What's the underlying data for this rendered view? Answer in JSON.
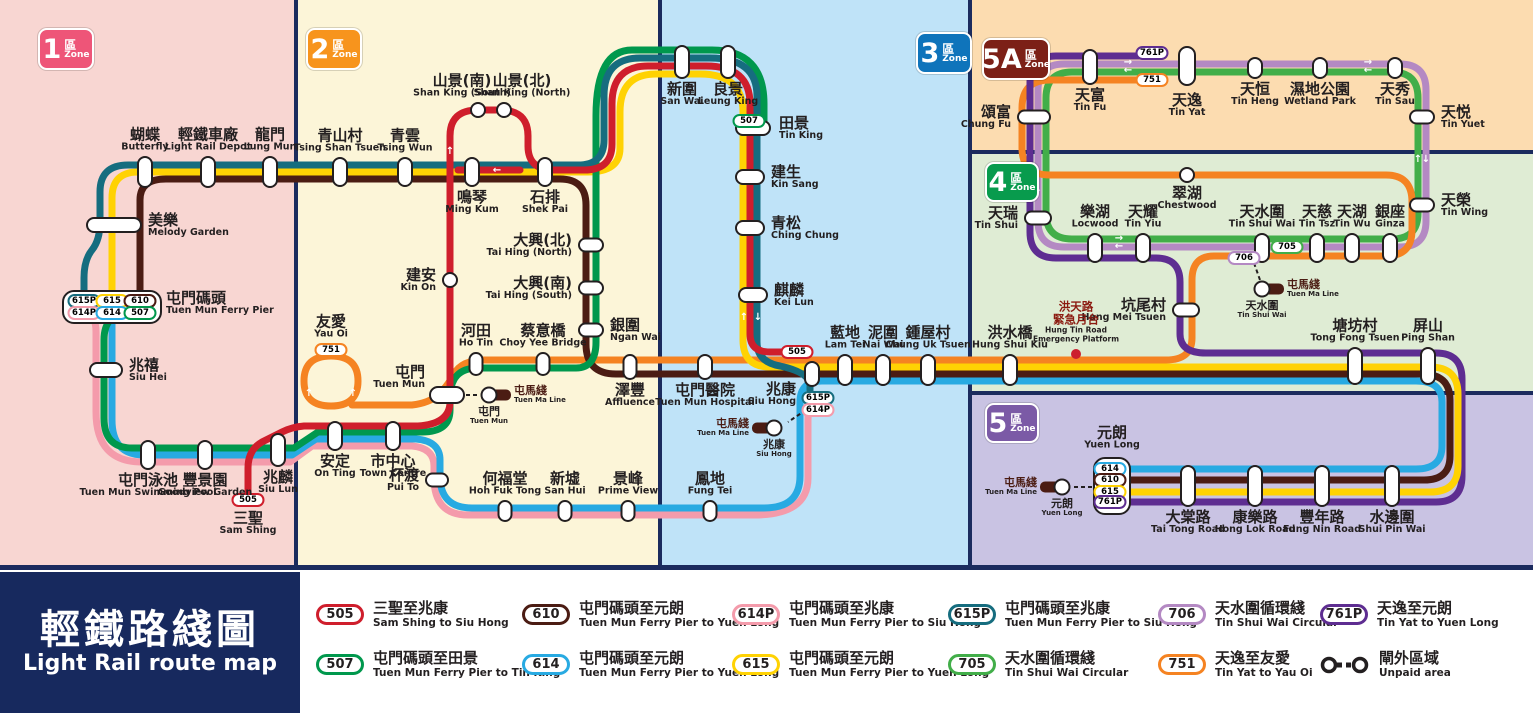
{
  "title": {
    "zh": "輕鐵路綫圖",
    "en": "Light Rail route map"
  },
  "mtr_line": {
    "zh": "屯馬綫",
    "en": "Tuen Ma Line"
  },
  "zones": [
    {
      "num": "1",
      "qu": "區",
      "zone_word": "Zone",
      "color": "#ee5578",
      "bg": "#f8d6d2",
      "rx": 0,
      "ry": 0,
      "rw": 296,
      "rh": 565,
      "bx": 38,
      "by": 28,
      "bw": 52,
      "bh": 38
    },
    {
      "num": "2",
      "qu": "區",
      "zone_word": "Zone",
      "color": "#f7941d",
      "bg": "#fcf5d8",
      "rx": 296,
      "ry": 0,
      "rw": 364,
      "rh": 565,
      "bx": 306,
      "by": 28,
      "bw": 52,
      "bh": 38
    },
    {
      "num": "3",
      "qu": "區",
      "zone_word": "Zone",
      "color": "#0f74bb",
      "bg": "#bfe3f8",
      "rx": 660,
      "ry": 0,
      "rw": 310,
      "rh": 565,
      "bx": 916,
      "by": 32,
      "bw": 52,
      "bh": 38
    },
    {
      "num": "5A",
      "qu": "區",
      "zone_word": "Zone",
      "color": "#7c2017",
      "bg": "#fcdcb0",
      "rx": 970,
      "ry": 0,
      "rw": 563,
      "rh": 152,
      "bx": 982,
      "by": 38,
      "bw": 64,
      "bh": 38
    },
    {
      "num": "4",
      "qu": "區",
      "zone_word": "Zone",
      "color": "#089b4d",
      "bg": "#dfecd4",
      "rx": 970,
      "ry": 152,
      "rw": 563,
      "rh": 241,
      "bx": 985,
      "by": 162,
      "bw": 50,
      "bh": 36
    },
    {
      "num": "5",
      "qu": "區",
      "zone_word": "Zone",
      "color": "#7b5aa6",
      "bg": "#c9c3e3",
      "rx": 970,
      "ry": 393,
      "rw": 563,
      "rh": 172,
      "bx": 985,
      "by": 403,
      "bw": 50,
      "bh": 36
    }
  ],
  "routes": [
    {
      "id": "505",
      "color": "#cf1e2c"
    },
    {
      "id": "507",
      "color": "#00984d"
    },
    {
      "id": "610",
      "color": "#4b1c13"
    },
    {
      "id": "614",
      "color": "#28aae2"
    },
    {
      "id": "614P",
      "color": "#f49bab"
    },
    {
      "id": "615",
      "color": "#ffd203"
    },
    {
      "id": "615P",
      "color": "#166d7f"
    },
    {
      "id": "705",
      "color": "#42ae49"
    },
    {
      "id": "706",
      "color": "#b489c3"
    },
    {
      "id": "751",
      "color": "#f58322"
    },
    {
      "id": "761P",
      "color": "#5e2d91"
    }
  ],
  "stations": [
    {
      "zh": "蝴蝶",
      "en": "Butterfly",
      "x": 145,
      "y": 172,
      "w": 16,
      "h": 32,
      "pos": "above"
    },
    {
      "zh": "輕鐵車廠",
      "en": "Light Rail Depot",
      "x": 208,
      "y": 172,
      "w": 16,
      "h": 32,
      "pos": "above"
    },
    {
      "zh": "龍門",
      "en": "Lung Mun",
      "x": 270,
      "y": 172,
      "w": 16,
      "h": 32,
      "pos": "above"
    },
    {
      "zh": "美樂",
      "en": "Melody Garden",
      "x": 114,
      "y": 225,
      "w": 56,
      "h": 16,
      "pos": "right"
    },
    {
      "zh": "屯門碼頭",
      "en": "Tuen Mun Ferry Pier",
      "x": 112,
      "y": 307,
      "w": 96,
      "h": 30,
      "pos": "right",
      "marker": false,
      "dy": -4
    },
    {
      "zh": "兆禧",
      "en": "Siu Hei",
      "x": 106,
      "y": 370,
      "w": 34,
      "h": 16,
      "pos": "right"
    },
    {
      "zh": "屯門泳池",
      "en": "Tuen Mun Swimming Pool",
      "x": 148,
      "y": 455,
      "w": 16,
      "h": 30,
      "pos": "below"
    },
    {
      "zh": "豐景園",
      "en": "Goodview Garden",
      "x": 205,
      "y": 455,
      "w": 16,
      "h": 30,
      "pos": "below"
    },
    {
      "zh": "兆麟",
      "en": "Siu Lun",
      "x": 278,
      "y": 450,
      "w": 16,
      "h": 34,
      "pos": "below"
    },
    {
      "zh": "三聖",
      "en": "Sam Shing",
      "x": 248,
      "y": 500,
      "w": 30,
      "h": 16,
      "pos": "below",
      "marker": false
    },
    {
      "zh": "青山村",
      "en": "Tsing Shan Tsuen",
      "x": 340,
      "y": 172,
      "w": 16,
      "h": 30,
      "pos": "above"
    },
    {
      "zh": "青雲",
      "en": "Tsing Wun",
      "x": 405,
      "y": 172,
      "w": 16,
      "h": 30,
      "pos": "above"
    },
    {
      "zh": "山景(南)",
      "en": "Shan King (South)",
      "x": 478,
      "y": 110,
      "w": 16,
      "h": 16,
      "pos": "above",
      "dx": -16
    },
    {
      "zh": "山景(北)",
      "en": "Shan King (North)",
      "x": 504,
      "y": 110,
      "w": 16,
      "h": 16,
      "pos": "above",
      "dx": 18
    },
    {
      "zh": "鳴琴",
      "en": "Ming Kum",
      "x": 472,
      "y": 172,
      "w": 16,
      "h": 30,
      "pos": "below"
    },
    {
      "zh": "石排",
      "en": "Shek Pai",
      "x": 545,
      "y": 172,
      "w": 16,
      "h": 30,
      "pos": "below"
    },
    {
      "zh": "建安",
      "en": "Kin On",
      "x": 450,
      "y": 280,
      "w": 16,
      "h": 16,
      "pos": "left"
    },
    {
      "zh": "大興(北)",
      "en": "Tai Hing (North)",
      "x": 591,
      "y": 245,
      "w": 26,
      "h": 15,
      "pos": "left"
    },
    {
      "zh": "大興(南)",
      "en": "Tai Hing (South)",
      "x": 591,
      "y": 288,
      "w": 26,
      "h": 15,
      "pos": "left"
    },
    {
      "zh": "銀圍",
      "en": "Ngan Wai",
      "x": 591,
      "y": 330,
      "w": 26,
      "h": 15,
      "pos": "right"
    },
    {
      "zh": "蔡意橋",
      "en": "Choy Yee Bridge",
      "x": 543,
      "y": 364,
      "w": 15,
      "h": 24,
      "pos": "above"
    },
    {
      "zh": "河田",
      "en": "Ho Tin",
      "x": 476,
      "y": 364,
      "w": 15,
      "h": 24,
      "pos": "above"
    },
    {
      "zh": "屯門",
      "en": "Tuen Mun",
      "x": 447,
      "y": 395,
      "w": 36,
      "h": 18,
      "pos": "left",
      "dx": 2,
      "dy": -18
    },
    {
      "zh": "友愛",
      "en": "Yau Oi",
      "x": 331,
      "y": 350,
      "w": 30,
      "h": 14,
      "pos": "above",
      "marker": false
    },
    {
      "zh": "安定",
      "en": "On Ting",
      "x": 335,
      "y": 436,
      "w": 16,
      "h": 30,
      "pos": "below"
    },
    {
      "zh": "市中心",
      "en": "Town Centre",
      "x": 393,
      "y": 436,
      "w": 16,
      "h": 30,
      "pos": "below"
    },
    {
      "zh": "杯渡",
      "en": "Pui To",
      "x": 437,
      "y": 480,
      "w": 24,
      "h": 15,
      "pos": "left"
    },
    {
      "zh": "何福堂",
      "en": "Hoh Fuk Tong",
      "x": 505,
      "y": 511,
      "w": 15,
      "h": 22,
      "pos": "above"
    },
    {
      "zh": "新墟",
      "en": "San Hui",
      "x": 565,
      "y": 511,
      "w": 15,
      "h": 22,
      "pos": "above"
    },
    {
      "zh": "景峰",
      "en": "Prime View",
      "x": 628,
      "y": 511,
      "w": 15,
      "h": 22,
      "pos": "above"
    },
    {
      "zh": "澤豐",
      "en": "Affluence",
      "x": 630,
      "y": 367,
      "w": 15,
      "h": 26,
      "pos": "below"
    },
    {
      "zh": "新圍",
      "en": "San Wai",
      "x": 682,
      "y": 62,
      "w": 16,
      "h": 34,
      "pos": "below"
    },
    {
      "zh": "良景",
      "en": "Leung King",
      "x": 728,
      "y": 62,
      "w": 16,
      "h": 34,
      "pos": "below"
    },
    {
      "zh": "田景",
      "en": "Tin King",
      "x": 753,
      "y": 128,
      "w": 36,
      "h": 16,
      "pos": "right",
      "dx": 2
    },
    {
      "zh": "建生",
      "en": "Kin Sang",
      "x": 750,
      "y": 177,
      "w": 30,
      "h": 16,
      "pos": "right"
    },
    {
      "zh": "青松",
      "en": "Ching Chung",
      "x": 750,
      "y": 228,
      "w": 30,
      "h": 16,
      "pos": "right"
    },
    {
      "zh": "麒麟",
      "en": "Kei Lun",
      "x": 753,
      "y": 295,
      "w": 30,
      "h": 16,
      "pos": "right"
    },
    {
      "zh": "藍地",
      "en": "Lam Tei",
      "x": 845,
      "y": 370,
      "w": 16,
      "h": 32,
      "pos": "above"
    },
    {
      "zh": "泥圍",
      "en": "Nai Wai",
      "x": 883,
      "y": 370,
      "w": 16,
      "h": 32,
      "pos": "above"
    },
    {
      "zh": "鍾屋村",
      "en": "Chung Uk Tsuen",
      "x": 928,
      "y": 370,
      "w": 16,
      "h": 32,
      "pos": "above"
    },
    {
      "zh": "屯門醫院",
      "en": "Tuen Mun Hospital",
      "x": 705,
      "y": 367,
      "w": 16,
      "h": 26,
      "pos": "below"
    },
    {
      "zh": "兆康",
      "en": "Siu Hong",
      "x": 812,
      "y": 374,
      "w": 16,
      "h": 26,
      "pos": "left",
      "dx": -2,
      "dy": 20
    },
    {
      "zh": "鳳地",
      "en": "Fung Tei",
      "x": 710,
      "y": 511,
      "w": 15,
      "h": 22,
      "pos": "above"
    },
    {
      "zh": "洪水橋",
      "en": "Hung Shui Kiu",
      "x": 1010,
      "y": 370,
      "w": 16,
      "h": 32,
      "pos": "above"
    },
    {
      "zh": "塘坊村",
      "en": "Tong Fong Tsuen",
      "x": 1355,
      "y": 366,
      "w": 16,
      "h": 38,
      "pos": "above"
    },
    {
      "zh": "屏山",
      "en": "Ping Shan",
      "x": 1428,
      "y": 366,
      "w": 16,
      "h": 38,
      "pos": "above"
    },
    {
      "zh": "坑尾村",
      "en": "Hang Mei Tsuen",
      "x": 1186,
      "y": 310,
      "w": 28,
      "h": 15,
      "pos": "left"
    },
    {
      "zh": "翠湖",
      "en": "Chestwood",
      "x": 1187,
      "y": 175,
      "w": 16,
      "h": 16,
      "pos": "below"
    },
    {
      "zh": "天瑞",
      "en": "Tin Shui",
      "x": 1038,
      "y": 218,
      "w": 28,
      "h": 15,
      "pos": "left"
    },
    {
      "zh": "樂湖",
      "en": "Locwood",
      "x": 1095,
      "y": 248,
      "w": 16,
      "h": 30,
      "pos": "above"
    },
    {
      "zh": "天耀",
      "en": "Tin Yiu",
      "x": 1143,
      "y": 248,
      "w": 16,
      "h": 30,
      "pos": "above"
    },
    {
      "zh": "天水圍",
      "en": "Tin Shui Wai",
      "x": 1262,
      "y": 248,
      "w": 16,
      "h": 30,
      "pos": "above"
    },
    {
      "zh": "天慈",
      "en": "Tin Tsz",
      "x": 1317,
      "y": 248,
      "w": 16,
      "h": 30,
      "pos": "above"
    },
    {
      "zh": "天湖",
      "en": "Tin Wu",
      "x": 1352,
      "y": 248,
      "w": 16,
      "h": 30,
      "pos": "above"
    },
    {
      "zh": "銀座",
      "en": "Ginza",
      "x": 1390,
      "y": 248,
      "w": 16,
      "h": 30,
      "pos": "above"
    },
    {
      "zh": "天榮",
      "en": "Tin Wing",
      "x": 1422,
      "y": 205,
      "w": 26,
      "h": 15,
      "pos": "right"
    },
    {
      "zh": "頌富",
      "en": "Chung Fu",
      "x": 1034,
      "y": 117,
      "w": 34,
      "h": 15,
      "pos": "left"
    },
    {
      "zh": "天富",
      "en": "Tin Fu",
      "x": 1090,
      "y": 67,
      "w": 16,
      "h": 36,
      "pos": "below"
    },
    {
      "zh": "天逸",
      "en": "Tin Yat",
      "x": 1187,
      "y": 66,
      "w": 18,
      "h": 40,
      "pos": "below",
      "dy": 4
    },
    {
      "zh": "天恒",
      "en": "Tin Heng",
      "x": 1255,
      "y": 68,
      "w": 16,
      "h": 22,
      "pos": "below"
    },
    {
      "zh": "濕地公園",
      "en": "Wetland Park",
      "x": 1320,
      "y": 68,
      "w": 16,
      "h": 22,
      "pos": "below"
    },
    {
      "zh": "天秀",
      "en": "Tin Sau",
      "x": 1395,
      "y": 68,
      "w": 16,
      "h": 22,
      "pos": "below"
    },
    {
      "zh": "天悦",
      "en": "Tin Yuet",
      "x": 1422,
      "y": 117,
      "w": 26,
      "h": 15,
      "pos": "right"
    },
    {
      "zh": "元朗",
      "en": "Yuen Long",
      "x": 1112,
      "y": 486,
      "w": 36,
      "h": 56,
      "pos": "above",
      "marker": false,
      "dy": -4
    },
    {
      "zh": "大棠路",
      "en": "Tai Tong Road",
      "x": 1188,
      "y": 486,
      "w": 16,
      "h": 42,
      "pos": "below"
    },
    {
      "zh": "康樂路",
      "en": "Hong Lok Road",
      "x": 1255,
      "y": 486,
      "w": 16,
      "h": 42,
      "pos": "below"
    },
    {
      "zh": "豐年路",
      "en": "Fung Nin Road",
      "x": 1322,
      "y": 486,
      "w": 16,
      "h": 42,
      "pos": "below"
    },
    {
      "zh": "水邊圍",
      "en": "Shui Pin Wai",
      "x": 1392,
      "y": 486,
      "w": 16,
      "h": 42,
      "pos": "below"
    }
  ],
  "backplates": [
    {
      "x": 112,
      "y": 307,
      "w": 100,
      "h": 34
    },
    {
      "x": 1112,
      "y": 486,
      "w": 38,
      "h": 58
    }
  ],
  "map_badges": [
    {
      "route": "615P",
      "x": 84,
      "y": 301
    },
    {
      "route": "615",
      "x": 112,
      "y": 301
    },
    {
      "route": "610",
      "x": 140,
      "y": 301
    },
    {
      "route": "614P",
      "x": 84,
      "y": 313
    },
    {
      "route": "614",
      "x": 112,
      "y": 313
    },
    {
      "route": "507",
      "x": 140,
      "y": 313
    },
    {
      "route": "505",
      "x": 248,
      "y": 500
    },
    {
      "route": "507",
      "x": 749,
      "y": 121
    },
    {
      "route": "751",
      "x": 331,
      "y": 350
    },
    {
      "route": "615P",
      "x": 818,
      "y": 398
    },
    {
      "route": "614P",
      "x": 818,
      "y": 410
    },
    {
      "route": "505",
      "x": 797,
      "y": 352
    },
    {
      "route": "761P",
      "x": 1152,
      "y": 53
    },
    {
      "route": "751",
      "x": 1152,
      "y": 80
    },
    {
      "route": "705",
      "x": 1287,
      "y": 247
    },
    {
      "route": "706",
      "x": 1244,
      "y": 258
    },
    {
      "route": "614",
      "x": 1110,
      "y": 469
    },
    {
      "route": "610",
      "x": 1110,
      "y": 480
    },
    {
      "route": "615",
      "x": 1110,
      "y": 492
    },
    {
      "route": "761P",
      "x": 1110,
      "y": 502
    }
  ],
  "mtr_interchanges": [
    {
      "zh": "屯門",
      "en": "Tuen Mun",
      "x": 489,
      "y": 395,
      "pill": "right",
      "label_side": "right",
      "dash": [
        466,
        395,
        478,
        395
      ]
    },
    {
      "zh": "兆康",
      "en": "Siu Hong",
      "x": 774,
      "y": 428,
      "pill": "left",
      "label_side": "left",
      "dash": [
        806,
        410,
        788,
        422
      ]
    },
    {
      "zh": "天水圍",
      "en": "Tin Shui Wai",
      "x": 1262,
      "y": 289,
      "pill": "right",
      "label_side": "right",
      "dash": [
        1254,
        263,
        1260,
        280
      ]
    },
    {
      "zh": "元朗",
      "en": "Yuen Long",
      "x": 1062,
      "y": 487,
      "pill": "left",
      "label_side": "left",
      "dash": [
        1074,
        487,
        1092,
        487
      ]
    }
  ],
  "emergency_platform": {
    "x": 1076,
    "y": 354,
    "zh1": "洪天路",
    "zh2": "緊急月台",
    "en1": "Hung Tin Road",
    "en2": "Emergency Platform"
  },
  "arrows": [
    {
      "x": 450,
      "y": 152,
      "ch": "↑"
    },
    {
      "x": 497,
      "y": 171,
      "ch": "←"
    },
    {
      "x": 744,
      "y": 318,
      "ch": "↑"
    },
    {
      "x": 758,
      "y": 318,
      "ch": "↓"
    },
    {
      "x": 309,
      "y": 394,
      "ch": "↑"
    },
    {
      "x": 353,
      "y": 394,
      "ch": "↑"
    },
    {
      "x": 1128,
      "y": 63,
      "ch": "→"
    },
    {
      "x": 1128,
      "y": 71,
      "ch": "←"
    },
    {
      "x": 1368,
      "y": 63,
      "ch": "→"
    },
    {
      "x": 1368,
      "y": 71,
      "ch": "←"
    },
    {
      "x": 1418,
      "y": 160,
      "ch": "↑"
    },
    {
      "x": 1426,
      "y": 160,
      "ch": "↓"
    },
    {
      "x": 1029,
      "y": 190,
      "ch": "↑"
    },
    {
      "x": 1038,
      "y": 190,
      "ch": "↓"
    },
    {
      "x": 1119,
      "y": 239,
      "ch": "→"
    },
    {
      "x": 1119,
      "y": 247,
      "ch": "←"
    }
  ],
  "legend": {
    "cols": [
      316,
      522,
      732,
      948,
      1158,
      1320
    ],
    "rows": [
      600,
      650
    ],
    "items": [
      {
        "route": "505",
        "zh": "三聖至兆康",
        "en": "Sam Shing to Siu Hong",
        "col": 0,
        "row": 0
      },
      {
        "route": "507",
        "zh": "屯門碼頭至田景",
        "en": "Tuen Mun Ferry Pier to Tin King",
        "col": 0,
        "row": 1
      },
      {
        "route": "610",
        "zh": "屯門碼頭至元朗",
        "en": "Tuen Mun Ferry Pier to Yuen Long",
        "col": 1,
        "row": 0
      },
      {
        "route": "614",
        "zh": "屯門碼頭至元朗",
        "en": "Tuen Mun Ferry Pier to Yuen Long",
        "col": 1,
        "row": 1
      },
      {
        "route": "614P",
        "zh": "屯門碼頭至兆康",
        "en": "Tuen Mun Ferry Pier to Siu Hong",
        "col": 2,
        "row": 0
      },
      {
        "route": "615",
        "zh": "屯門碼頭至元朗",
        "en": "Tuen Mun Ferry Pier to Yuen Long",
        "col": 2,
        "row": 1
      },
      {
        "route": "615P",
        "zh": "屯門碼頭至兆康",
        "en": "Tuen Mun Ferry Pier to Siu Hong",
        "col": 3,
        "row": 0
      },
      {
        "route": "705",
        "zh": "天水圍循環綫",
        "en": "Tin Shui Wai Circular",
        "col": 3,
        "row": 1
      },
      {
        "route": "706",
        "zh": "天水圍循環綫",
        "en": "Tin Shui Wai Circular",
        "col": 4,
        "row": 0
      },
      {
        "route": "751",
        "zh": "天逸至友愛",
        "en": "Tin Yat to Yau Oi",
        "col": 4,
        "row": 1
      },
      {
        "route": "761P",
        "zh": "天逸至元朗",
        "en": "Tin Yat to Yuen Long",
        "col": 5,
        "row": 0
      }
    ],
    "unpaid": {
      "zh": "閘外區域",
      "en": "Unpaid area",
      "col": 5,
      "row": 1
    }
  }
}
